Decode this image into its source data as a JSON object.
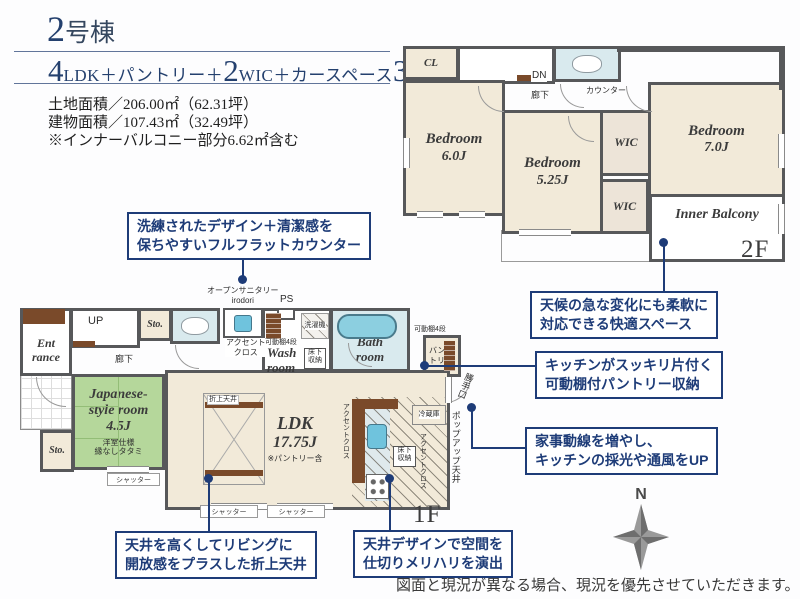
{
  "colors": {
    "accent_navy": "#1e3c78",
    "title_navy": "#24406e",
    "wall_gray": "#57585a",
    "room_beige": "#f2ead9",
    "tatami_green": "#b5d79b",
    "water_blue": "#d9eaee",
    "tub_blue": "#8ccfe0",
    "wood_brown": "#7a4a2a"
  },
  "header": {
    "title_big": "2",
    "title_rest": "号棟",
    "spec": {
      "n1": "4",
      "t1": "LDK＋パントリー＋",
      "n2": "2",
      "t2": "WIC＋カースペース",
      "n3": "3",
      "t3": "台"
    },
    "land_area": "土地面積／206.00㎡（62.31坪）",
    "building_area": "建物面積／107.43㎡（32.49坪）",
    "note": "※インナーバルコニー部分6.62㎡含む"
  },
  "floor2": {
    "floor_label": "2F",
    "cl": "CL",
    "dn": "DN",
    "hallway": "廊下",
    "counter": "カウンター",
    "bedroom1": {
      "name": "Bedroom",
      "size": "6.0J"
    },
    "bedroom2": {
      "name": "Bedroom",
      "size": "5.25J"
    },
    "bedroom3": {
      "name": "Bedroom",
      "size": "7.0J"
    },
    "wic1": "WIC",
    "wic2": "WIC",
    "inner_balcony": "Inner Balcony"
  },
  "floor1": {
    "floor_label": "1F",
    "up": "UP",
    "hallway": "廊下",
    "entrance": {
      "line1": "Ent",
      "line2": "rance"
    },
    "storage1": "Sto.",
    "storage2": "Sto.",
    "open_sanitary": {
      "line1": "オープンサニタリー",
      "line2": "irodori"
    },
    "ps": "PS",
    "accent_cloth_sanitary": {
      "line1": "アクセント",
      "line2": "クロス"
    },
    "shelf_wash": "可動棚4段",
    "shelf_pantry": "可動棚4段",
    "washroom": {
      "line1": "Wash",
      "line2": "room"
    },
    "underfloor_wash": {
      "line1": "床下",
      "line2": "収納"
    },
    "washing_machine": "洗濯機",
    "bathroom": {
      "line1": "Bath",
      "line2": "room"
    },
    "pantry": {
      "line1": "バン",
      "line2": "トリー"
    },
    "back_door": "勝手口",
    "japanese_room": {
      "line1": "Japanese-",
      "line2": "style room",
      "line3": "4.5J",
      "sub1": "洋室仕様",
      "sub2": "縁なしタタミ"
    },
    "ldk": {
      "name": "LDK",
      "size": "17.75J",
      "note": "※パントリー含"
    },
    "folded_ceiling": "折上天井",
    "accent_cloth_v1": "アクセントクロス",
    "accent_cloth_v2": "アクセントクロス",
    "refrigerator": "冷蔵庫",
    "underfloor_kitchen": {
      "line1": "床下",
      "line2": "収納"
    },
    "popup_ceiling": "ポップアップ天井",
    "shutter1": "シャッター",
    "shutter2": "シャッター",
    "shutter3": "シャッター"
  },
  "callouts": [
    {
      "line1": "洗練されたデザイン＋清潔感を",
      "line2": "保ちやすいフルフラットカウンター"
    },
    {
      "line1": "天候の急な変化にも柔軟に",
      "line2": "対応できる快適スペース"
    },
    {
      "line1": "キッチンがスッキリ片付く",
      "line2": "可動棚付パントリー収納"
    },
    {
      "line1": "家事動線を増やし、",
      "line2": "キッチンの採光や通風をUP"
    },
    {
      "line1": "天井を高くしてリビングに",
      "line2": "開放感をプラスした折上天井"
    },
    {
      "line1": "天井デザインで空間を",
      "line2": "仕切りメリハリを演出"
    }
  ],
  "compass": {
    "label": "N"
  },
  "disclaimer": "図面と現況が異なる場合、現況を優先させていただきます。"
}
